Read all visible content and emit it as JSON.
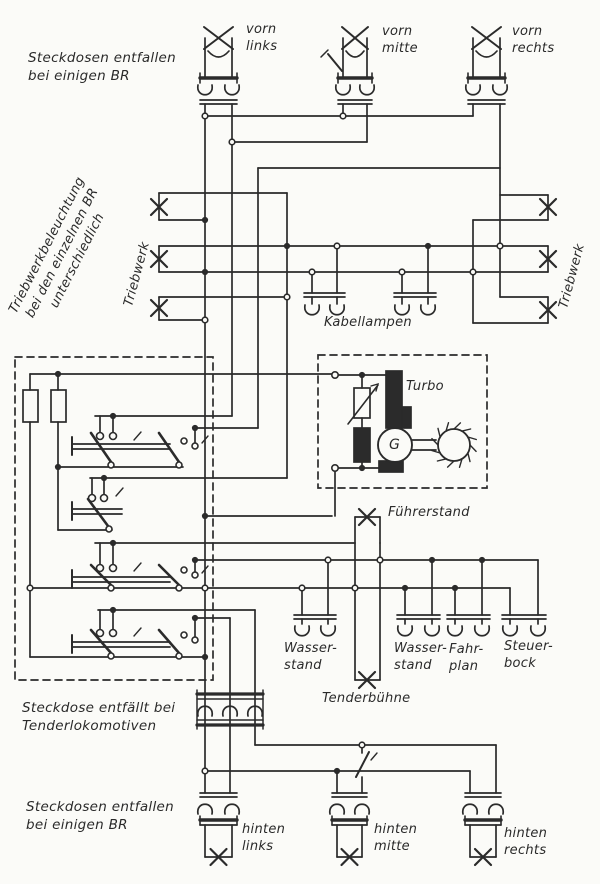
{
  "notes": {
    "top": "Steckdosen entfallen\nbei einigen BR",
    "triebwerk_beleuchtung": "Triebwerkbeleuchtung\nbei den einzelnen BR\nunterschiedlich",
    "middle": "Steckdose entfällt bei\nTenderlokomotiven",
    "bottom": "Steckdosen entfallen\nbei einigen BR"
  },
  "lamps": {
    "vorn_links": "vorn\nlinks",
    "vorn_mitte": "vorn\nmitte",
    "vorn_rechts": "vorn\nrechts",
    "triebwerk_left": "Triebwerk",
    "triebwerk_right": "Triebwerk",
    "kabellampen": "Kabellampen",
    "fuehrerstand": "Führerstand",
    "tenderbuehne": "Tenderbühne",
    "hinten_links": "hinten\nlinks",
    "hinten_mitte": "hinten\nmitte",
    "hinten_rechts": "hinten\nrechts"
  },
  "sockets": {
    "wasserstand_1": "Wasser-\nstand",
    "wasserstand_2": "Wasser-\nstand",
    "fahrplan": "Fahr-\nplan",
    "steuerbock": "Steuer-\nbock"
  },
  "turbo": {
    "label": "Turbo",
    "generator": "G"
  },
  "colors": {
    "ink": "#2b2b2b",
    "paper": "#fbfbf8"
  }
}
